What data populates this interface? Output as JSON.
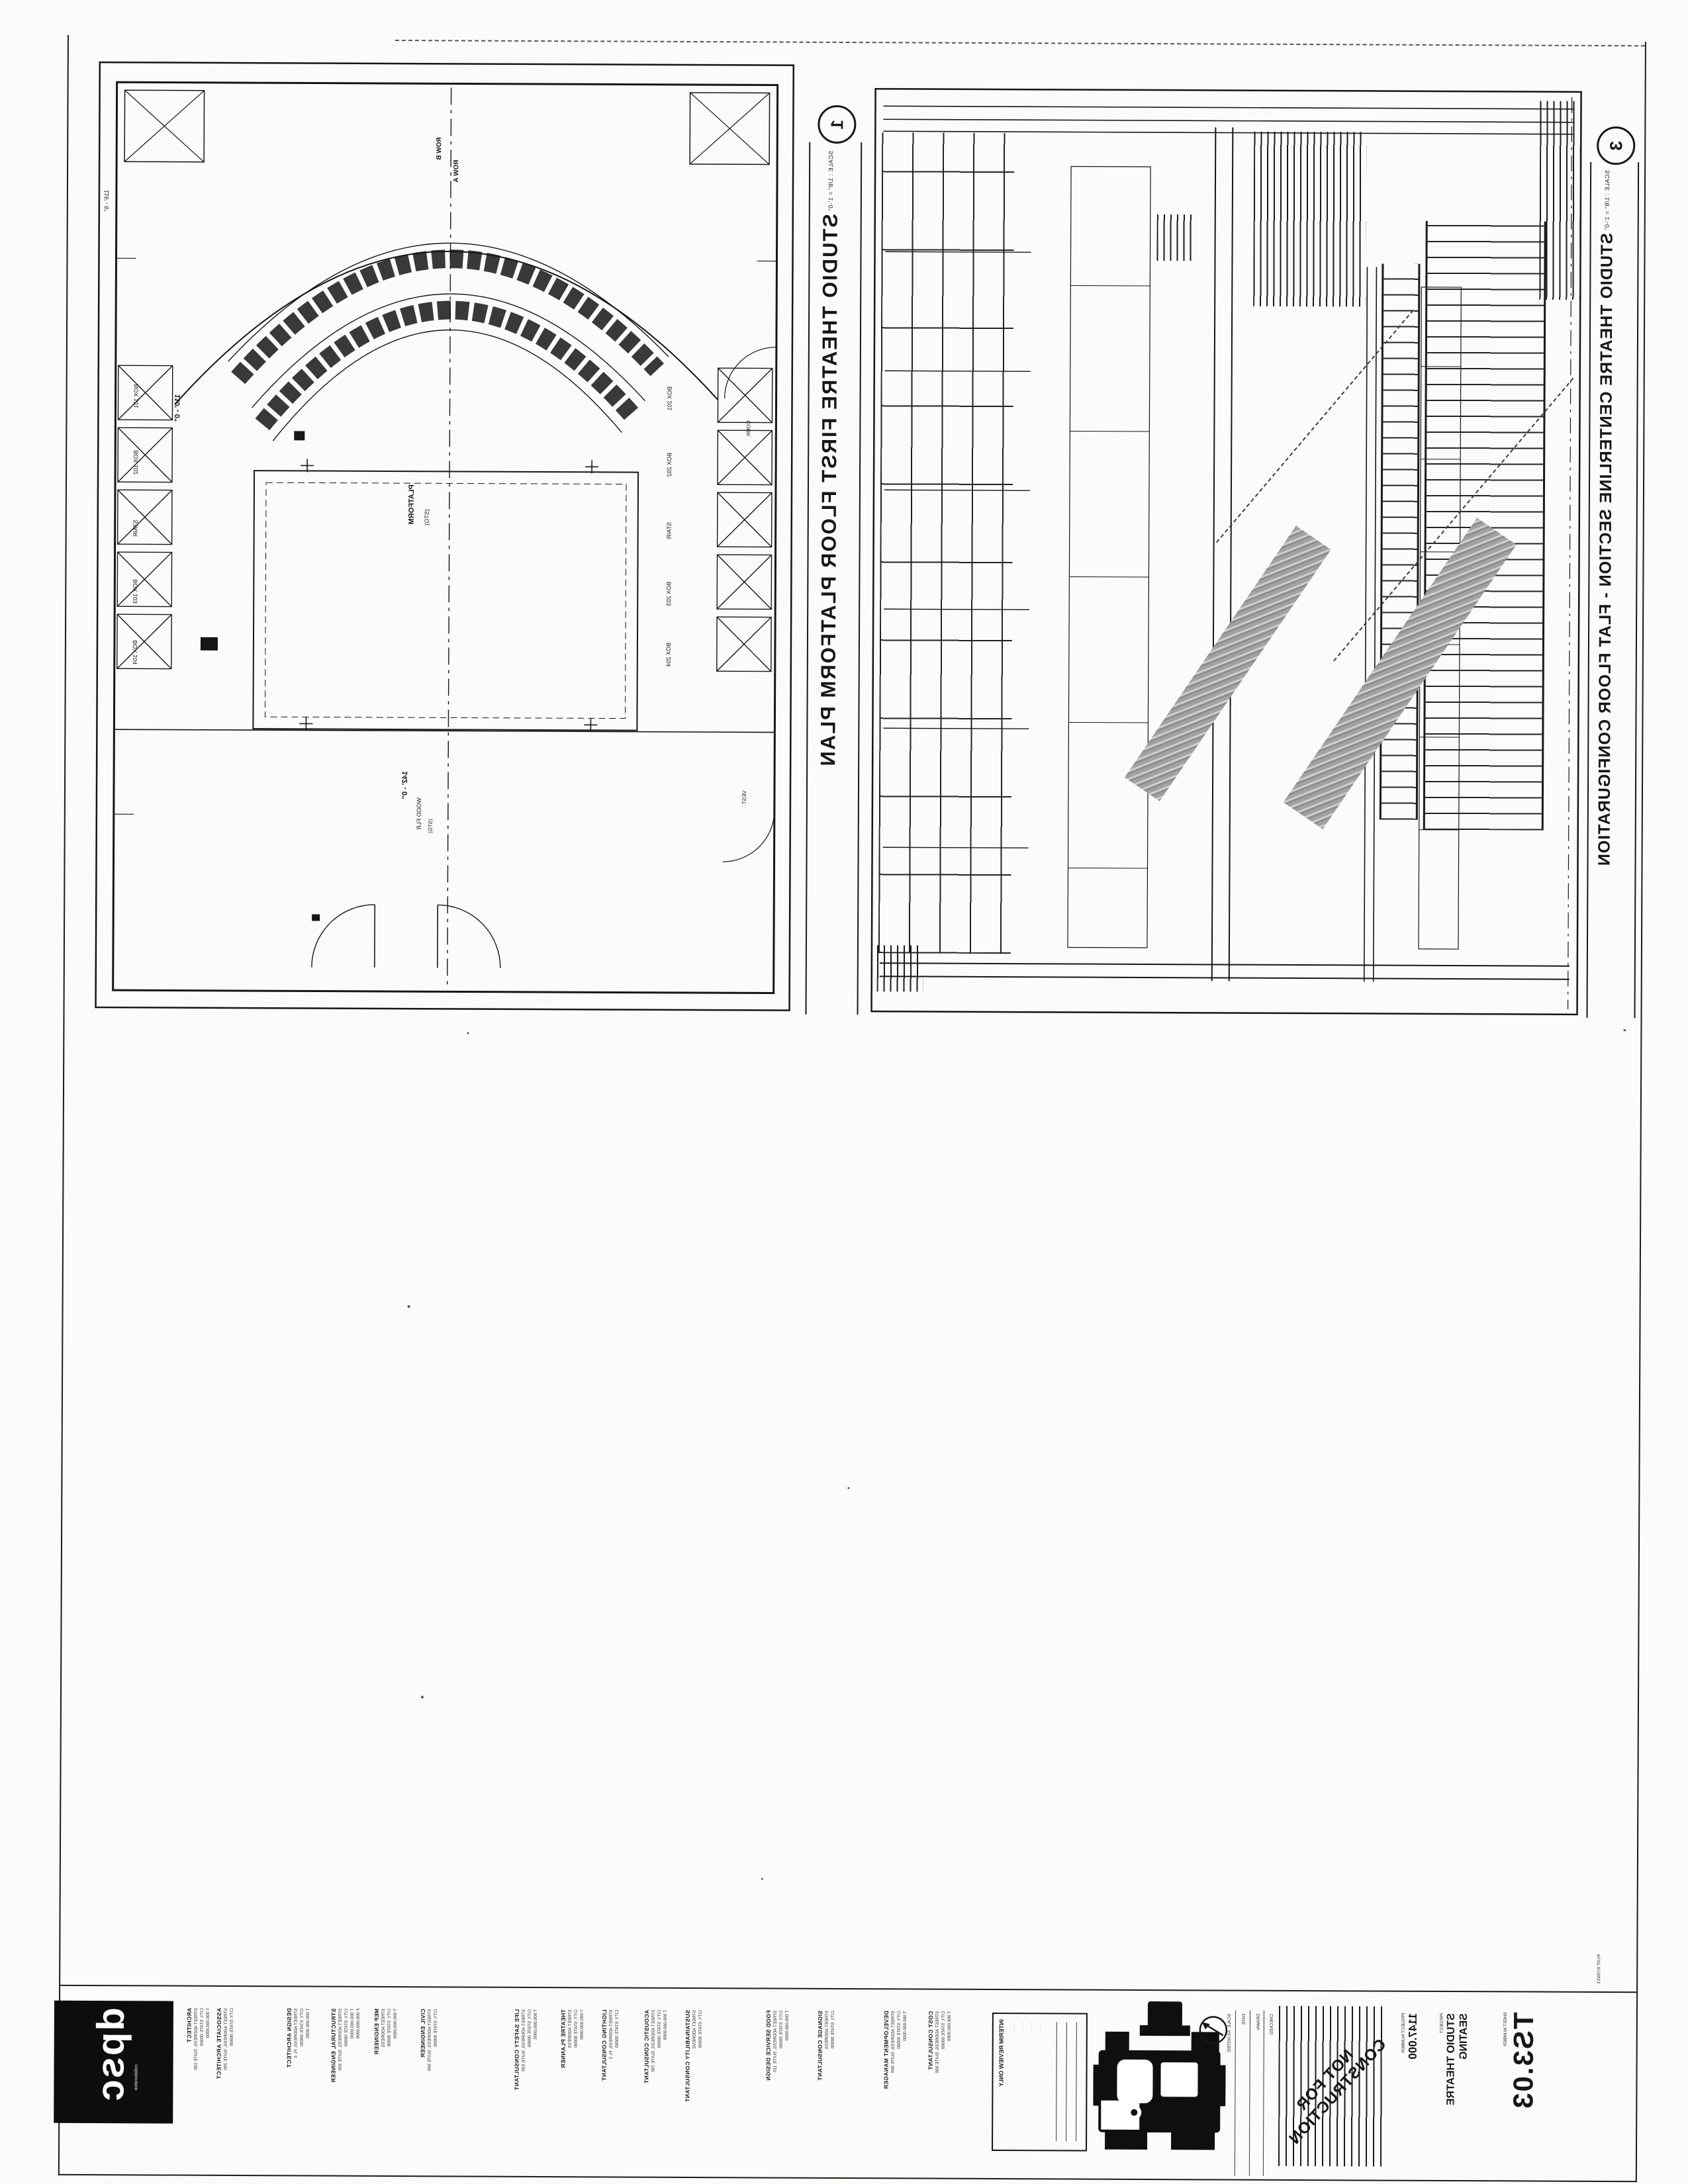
{
  "sheet": {
    "number_label": "SHEET NUMBER",
    "number": "TS3.03",
    "project_label": "PROJECT",
    "title_lines": [
      "STUDIO THEATRE",
      "SEATING"
    ],
    "project_number_label": "PROJECT NUMBER",
    "project_number": "1147.000",
    "plot_stamp": "PLOT 07/26/13",
    "stamp_line1": "NOT FOR",
    "stamp_line2": "CONSTRUCTION",
    "interim_header": "INTERIM REVIEW ONLY",
    "interim_rows": [
      "· · · · ·",
      "· · · · ·",
      "· · · · ·",
      "· · · · ·"
    ],
    "fields": [
      {
        "label": "SCALE",
        "value": "AS NOTED"
      },
      {
        "label": "DATE",
        "value": ""
      },
      {
        "label": "DRAWN",
        "value": ""
      },
      {
        "label": "CHECKED",
        "value": ""
      }
    ],
    "ink_color": "#161616",
    "halftone_color": "#8d8d8d"
  },
  "logo": {
    "text": "dpsc",
    "caption": "collaborative"
  },
  "drawings": [
    {
      "num": "1",
      "scale": "SCALE : 1/8\" = 1'-0\"",
      "title": "STUDIO THEATRE FIRST FLOOR PLATFORM PLAN"
    },
    {
      "num": "3",
      "scale": "SCALE : 1/8\" = 1'-0\"",
      "title": "STUDIO THEATRE CENTERLINE SECTION - FLAT FLOOR CONFIGURATION"
    }
  ],
  "plan_labels": {
    "row_b": "ROW B",
    "row_a": "ROW A",
    "dim_width": "110' - 0\"",
    "dim_left": "116' - 6\"",
    "dim_stage": "142' - 0\"",
    "platform": "PLATFORM",
    "stg": "(STG)",
    "wood": "WOOD FLR",
    "stg2": "(STG)",
    "corr": "CORR.",
    "vest": "VEST.",
    "boxes_left": [
      "BOX 101",
      "BOX 102",
      "STAIR",
      "BOX 103",
      "BOX 104"
    ],
    "boxes_right": [
      "BOX 201",
      "BOX 202",
      "STAIR",
      "BOX 203",
      "BOX 204"
    ]
  },
  "consultants": [
    {
      "header": "ARCHITECT",
      "lines": [
        "STREET ADDRESS, SUITE 100",
        "CITY, STATE 00000",
        "T 000.000.0000"
      ]
    },
    {
      "header": "ASSOCIATE ARCHITECT",
      "lines": [
        "STREET ADDRESS, SUITE 200",
        "CITY, STATE 00000"
      ]
    },
    {
      "header": "DESIGN ARCHITECT",
      "lines": [
        "STREET ADDRESS, FL 4",
        "CITY, STATE 00000",
        "T 000.000.0000"
      ]
    },
    {
      "header": "STRUCTURAL ENGINEER",
      "lines": [
        "STREET ADDRESS, SUITE 300",
        "CITY, STATE 00000",
        "T 000.000.0000",
        "F 000.000.0000"
      ]
    },
    {
      "header": "MEP ENGINEER",
      "lines": [
        "STREET ADDRESS",
        "CITY, STATE 00000",
        "T 000.000.0000"
      ]
    },
    {
      "header": "CIVIL ENGINEER",
      "lines": [
        "STREET ADDRESS, SUITE 900",
        "CITY, STATE 00000"
      ]
    },
    {
      "header": "LIFE SAFETY CONSULTANT",
      "lines": [
        "STREET ADDRESS, SUITE 500",
        "CITY, STATE 00000",
        "T 000.000.0000"
      ]
    },
    {
      "header": "THEATRE PLANNER",
      "lines": [
        "STREET ADDRESS",
        "CITY, STATE 00000",
        "T 000.000.0000"
      ]
    },
    {
      "header": "LIGHTING CONSULTANT",
      "lines": [
        "STREET ADDRESS, FL 2",
        "CITY, STATE 00000"
      ]
    },
    {
      "header": "ACOUSTIC CONSULTANT",
      "lines": [
        "STREET ADDRESS, SUITE 700",
        "CITY, STATE 00000",
        "T 000.000.0000"
      ]
    },
    {
      "header": "SUSTAINABILITY CONSULTANT",
      "lines": [
        "STREET ADDRESS",
        "CITY, STATE 00000"
      ]
    },
    {
      "header": "FOOD SERVICE DESIGN",
      "lines": [
        "STREET ADDRESS, SUITE 110",
        "CITY, STATE 00000",
        "T 000.000.0000"
      ]
    },
    {
      "header": "SIGNAGE CONSULTANT",
      "lines": [
        "STREET ADDRESS",
        "CITY, STATE 00000"
      ]
    },
    {
      "header": "DEVELOPMENT MANAGER",
      "lines": [
        "STREET ADDRESS, SUITE 800",
        "CITY, STATE 00000",
        "T 000.000.0000"
      ]
    },
    {
      "header": "COST CONSULTANT",
      "lines": [
        "STREET ADDRESS, SUITE 600",
        "CITY, STATE 00000",
        "T 000.000.0000"
      ]
    }
  ]
}
